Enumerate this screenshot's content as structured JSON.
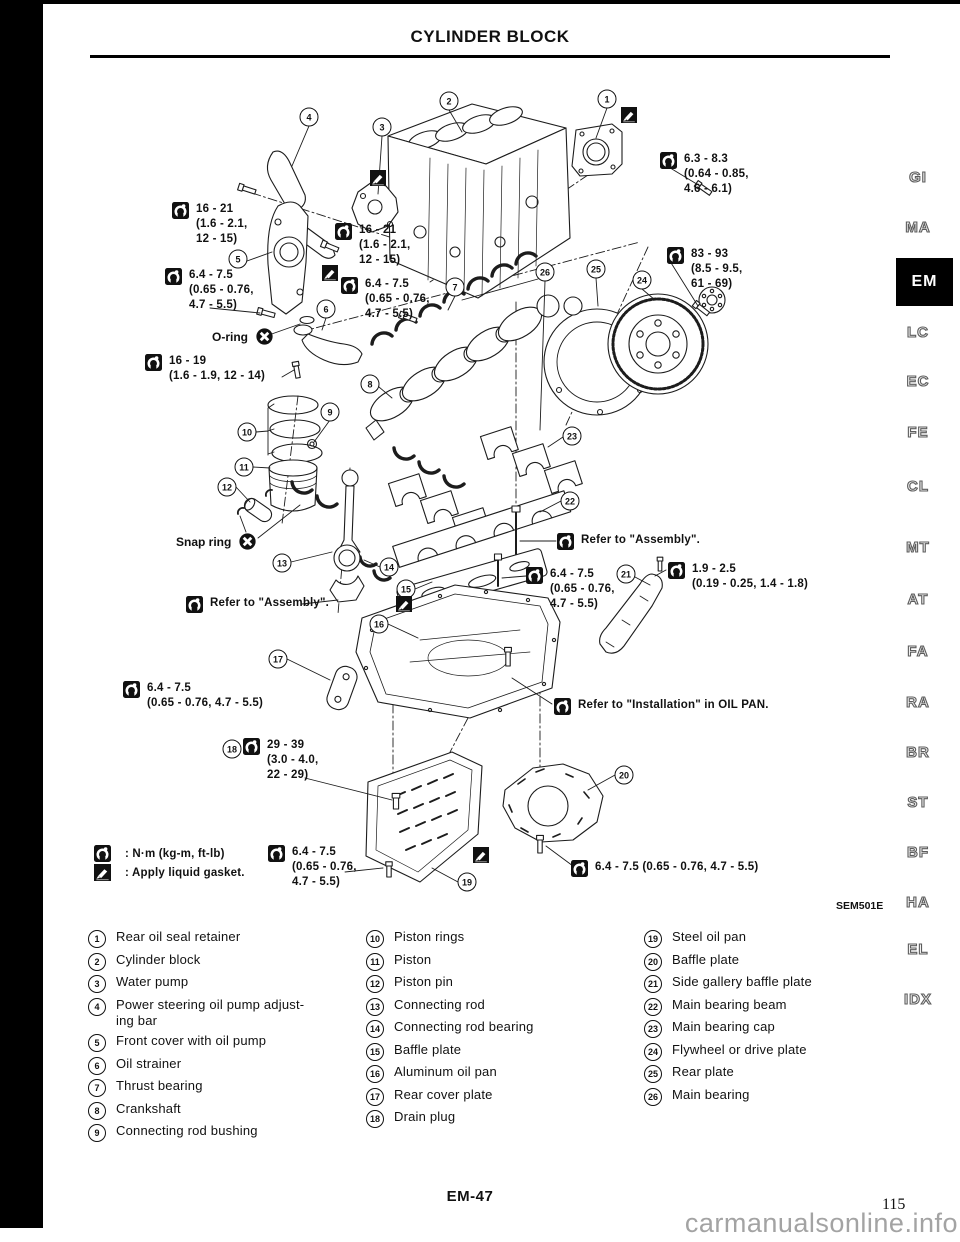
{
  "page": {
    "title": "CYLINDER BLOCK",
    "figure_code": "SEM501E",
    "page_code": "EM-47",
    "page_number": "115",
    "watermark": "carmanualsonline.info"
  },
  "colors": {
    "ink": "#111111",
    "watermark": "#a3a3a3"
  },
  "sidebar": {
    "items": [
      {
        "label": "GI",
        "top": 169,
        "cls": ""
      },
      {
        "label": "MA",
        "top": 219,
        "cls": ""
      },
      {
        "label": "EM",
        "top": 258,
        "cls": "active"
      },
      {
        "label": "LC",
        "top": 324,
        "cls": ""
      },
      {
        "label": "EC",
        "top": 373,
        "cls": ""
      },
      {
        "label": "FE",
        "top": 424,
        "cls": ""
      },
      {
        "label": "CL",
        "top": 478,
        "cls": ""
      },
      {
        "label": "MT",
        "top": 539,
        "cls": ""
      },
      {
        "label": "AT",
        "top": 591,
        "cls": ""
      },
      {
        "label": "FA",
        "top": 643,
        "cls": ""
      },
      {
        "label": "RA",
        "top": 694,
        "cls": ""
      },
      {
        "label": "BR",
        "top": 744,
        "cls": ""
      },
      {
        "label": "ST",
        "top": 794,
        "cls": ""
      },
      {
        "label": "BF",
        "top": 844,
        "cls": ""
      },
      {
        "label": "HA",
        "top": 894,
        "cls": ""
      },
      {
        "label": "EL",
        "top": 941,
        "cls": ""
      },
      {
        "label": "IDX",
        "top": 991,
        "cls": ""
      }
    ]
  },
  "legend": {
    "torque_label": ": N·m (kg-m, ft-lb)",
    "gasket_label": ": Apply liquid gasket."
  },
  "diagram": {
    "torque_labels": [
      {
        "text": "16 - 21\n(1.6 - 2.1,\n12 - 15)",
        "x": 172,
        "y": 202
      },
      {
        "text": "6.4 - 7.5\n(0.65 - 0.76,\n4.7 - 5.5)",
        "x": 165,
        "y": 268
      },
      {
        "text": "16 - 19\n(1.6 - 1.9, 12 - 14)",
        "x": 145,
        "y": 354
      },
      {
        "text": "16 - 21\n(1.6 - 2.1,\n12 - 15)",
        "x": 335,
        "y": 223
      },
      {
        "text": "6.4 - 7.5\n(0.65 - 0.76,\n4.7 - 5.5)",
        "x": 341,
        "y": 277
      },
      {
        "text": "6.3 - 8.3\n(0.64 - 0.85,\n4.6 - 6.1)",
        "x": 660,
        "y": 152
      },
      {
        "text": "83 - 93\n(8.5 - 9.5,\n61 - 69)",
        "x": 667,
        "y": 247
      },
      {
        "text": "Refer to \"Assembly\".",
        "x": 557,
        "y": 533
      },
      {
        "text": "6.4 - 7.5\n(0.65 - 0.76,\n4.7 - 5.5)",
        "x": 526,
        "y": 567
      },
      {
        "text": "1.9 - 2.5\n(0.19 - 0.25, 1.4 - 1.8)",
        "x": 668,
        "y": 562
      },
      {
        "text": "Refer to \"Assembly\".",
        "x": 186,
        "y": 596
      },
      {
        "text": "6.4 - 7.5\n(0.65 - 0.76, 4.7 - 5.5)",
        "x": 123,
        "y": 681
      },
      {
        "text": "29 - 39\n(3.0 - 4.0,\n22 - 29)",
        "x": 243,
        "y": 738
      },
      {
        "text": "Refer to \"Installation\" in OIL PAN.",
        "x": 554,
        "y": 698
      },
      {
        "text": "6.4 - 7.5\n(0.65 - 0.76,\n4.7 - 5.5)",
        "x": 268,
        "y": 845
      },
      {
        "text": "6.4 - 7.5 (0.65 - 0.76, 4.7 - 5.5)",
        "x": 571,
        "y": 860
      }
    ],
    "text_labels": [
      {
        "text": "O-ring",
        "x": 212,
        "y": 328
      },
      {
        "text": "Snap ring",
        "x": 176,
        "y": 533
      }
    ],
    "gasket_icons": [
      {
        "x": 621,
        "y": 107
      },
      {
        "x": 370,
        "y": 170
      },
      {
        "x": 322,
        "y": 265
      },
      {
        "x": 396,
        "y": 596
      },
      {
        "x": 473,
        "y": 847
      }
    ],
    "callouts": [
      {
        "n": "1",
        "x": 607,
        "y": 99
      },
      {
        "n": "2",
        "x": 449,
        "y": 101
      },
      {
        "n": "3",
        "x": 382,
        "y": 127
      },
      {
        "n": "4",
        "x": 309,
        "y": 117
      },
      {
        "n": "5",
        "x": 238,
        "y": 259
      },
      {
        "n": "6",
        "x": 326,
        "y": 309
      },
      {
        "n": "7",
        "x": 455,
        "y": 287
      },
      {
        "n": "8",
        "x": 370,
        "y": 384
      },
      {
        "n": "9",
        "x": 330,
        "y": 412
      },
      {
        "n": "10",
        "x": 247,
        "y": 432
      },
      {
        "n": "11",
        "x": 244,
        "y": 467
      },
      {
        "n": "12",
        "x": 227,
        "y": 487
      },
      {
        "n": "13",
        "x": 282,
        "y": 563
      },
      {
        "n": "14",
        "x": 389,
        "y": 567
      },
      {
        "n": "15",
        "x": 406,
        "y": 589
      },
      {
        "n": "16",
        "x": 379,
        "y": 624
      },
      {
        "n": "17",
        "x": 278,
        "y": 659
      },
      {
        "n": "18",
        "x": 232,
        "y": 749
      },
      {
        "n": "19",
        "x": 467,
        "y": 882
      },
      {
        "n": "20",
        "x": 624,
        "y": 775
      },
      {
        "n": "21",
        "x": 626,
        "y": 574
      },
      {
        "n": "22",
        "x": 570,
        "y": 501
      },
      {
        "n": "23",
        "x": 572,
        "y": 436
      },
      {
        "n": "24",
        "x": 642,
        "y": 280
      },
      {
        "n": "25",
        "x": 596,
        "y": 269
      },
      {
        "n": "26",
        "x": 545,
        "y": 272
      }
    ]
  },
  "parts": {
    "col1": [
      {
        "n": "1",
        "label": "Rear oil seal retainer"
      },
      {
        "n": "2",
        "label": "Cylinder block"
      },
      {
        "n": "3",
        "label": "Water pump"
      },
      {
        "n": "4",
        "label": "Power steering oil pump adjust-\ning bar"
      },
      {
        "n": "5",
        "label": "Front cover with oil pump"
      },
      {
        "n": "6",
        "label": "Oil strainer"
      },
      {
        "n": "7",
        "label": "Thrust bearing"
      },
      {
        "n": "8",
        "label": "Crankshaft"
      },
      {
        "n": "9",
        "label": "Connecting rod bushing"
      }
    ],
    "col2": [
      {
        "n": "10",
        "label": "Piston rings"
      },
      {
        "n": "11",
        "label": "Piston"
      },
      {
        "n": "12",
        "label": "Piston pin"
      },
      {
        "n": "13",
        "label": "Connecting rod"
      },
      {
        "n": "14",
        "label": "Connecting rod bearing"
      },
      {
        "n": "15",
        "label": "Baffle plate"
      },
      {
        "n": "16",
        "label": "Aluminum oil pan"
      },
      {
        "n": "17",
        "label": "Rear cover plate"
      },
      {
        "n": "18",
        "label": "Drain plug"
      }
    ],
    "col3": [
      {
        "n": "19",
        "label": "Steel oil pan"
      },
      {
        "n": "20",
        "label": "Baffle plate"
      },
      {
        "n": "21",
        "label": "Side gallery baffle plate"
      },
      {
        "n": "22",
        "label": "Main bearing beam"
      },
      {
        "n": "23",
        "label": "Main bearing cap"
      },
      {
        "n": "24",
        "label": "Flywheel or drive plate"
      },
      {
        "n": "25",
        "label": "Rear plate"
      },
      {
        "n": "26",
        "label": "Main bearing"
      }
    ]
  }
}
